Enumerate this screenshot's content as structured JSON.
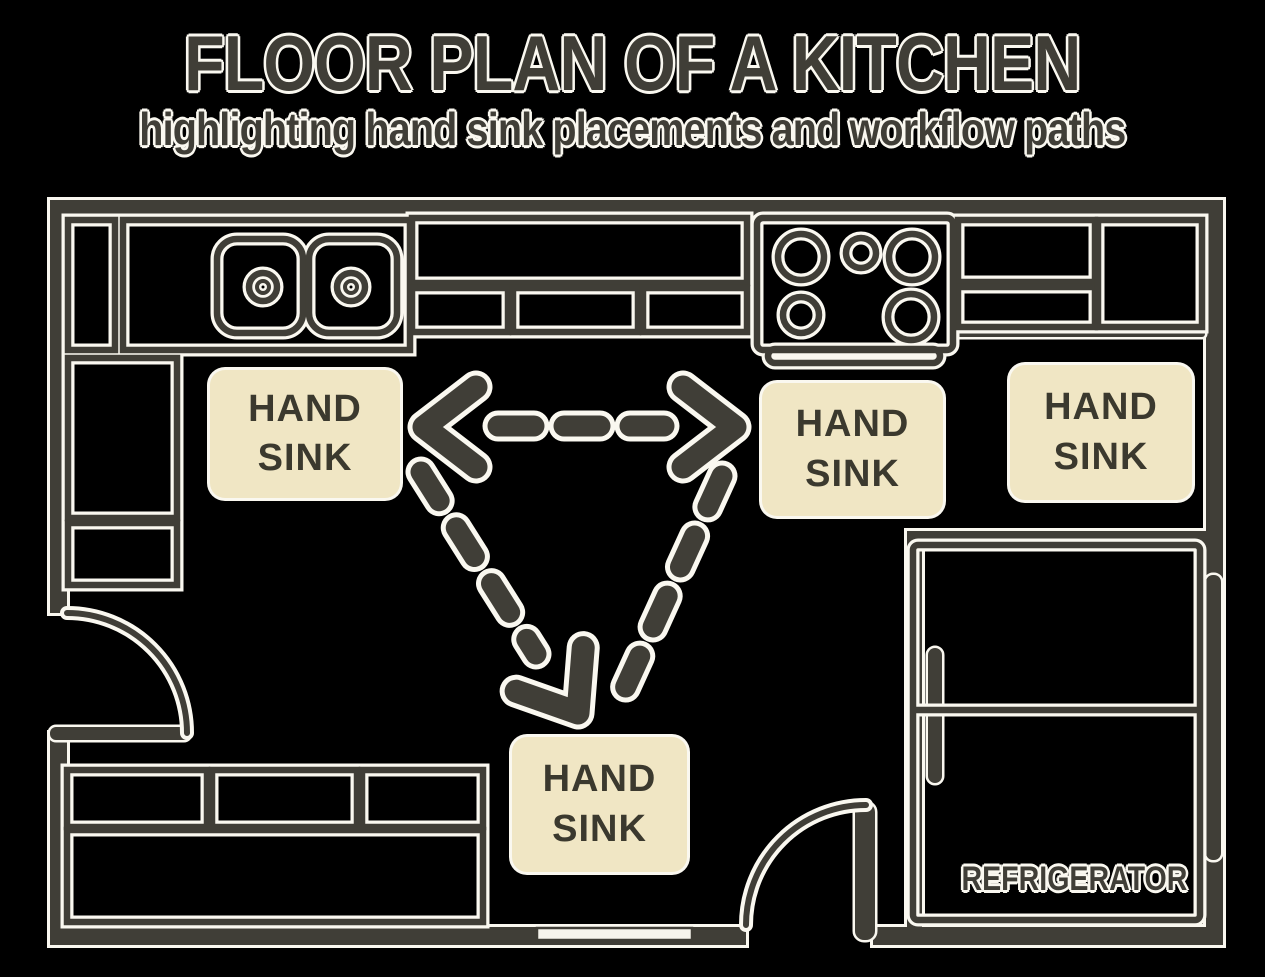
{
  "header": {
    "title": "FLOOR PLAN OF A KITCHEN",
    "subtitle": "highlighting hand sink placements and workflow paths"
  },
  "labels": {
    "hand_sink_line1": "HAND",
    "hand_sink_line2": "SINK",
    "refrigerator": "REFRIGERATOR"
  },
  "colors": {
    "background": "#000000",
    "wall": "#403e37",
    "outline": "#faf8f0",
    "label-bg": "#f0e6c4",
    "label-text": "#3b392e"
  },
  "icons": {
    "sink": "double-basin-sink-icon",
    "stove": "four-burner-stove-icon",
    "refrigerator": "refrigerator-icon",
    "door": "door-swing-arc-icon",
    "workflow": "dashed-workflow-arrow-icon"
  }
}
